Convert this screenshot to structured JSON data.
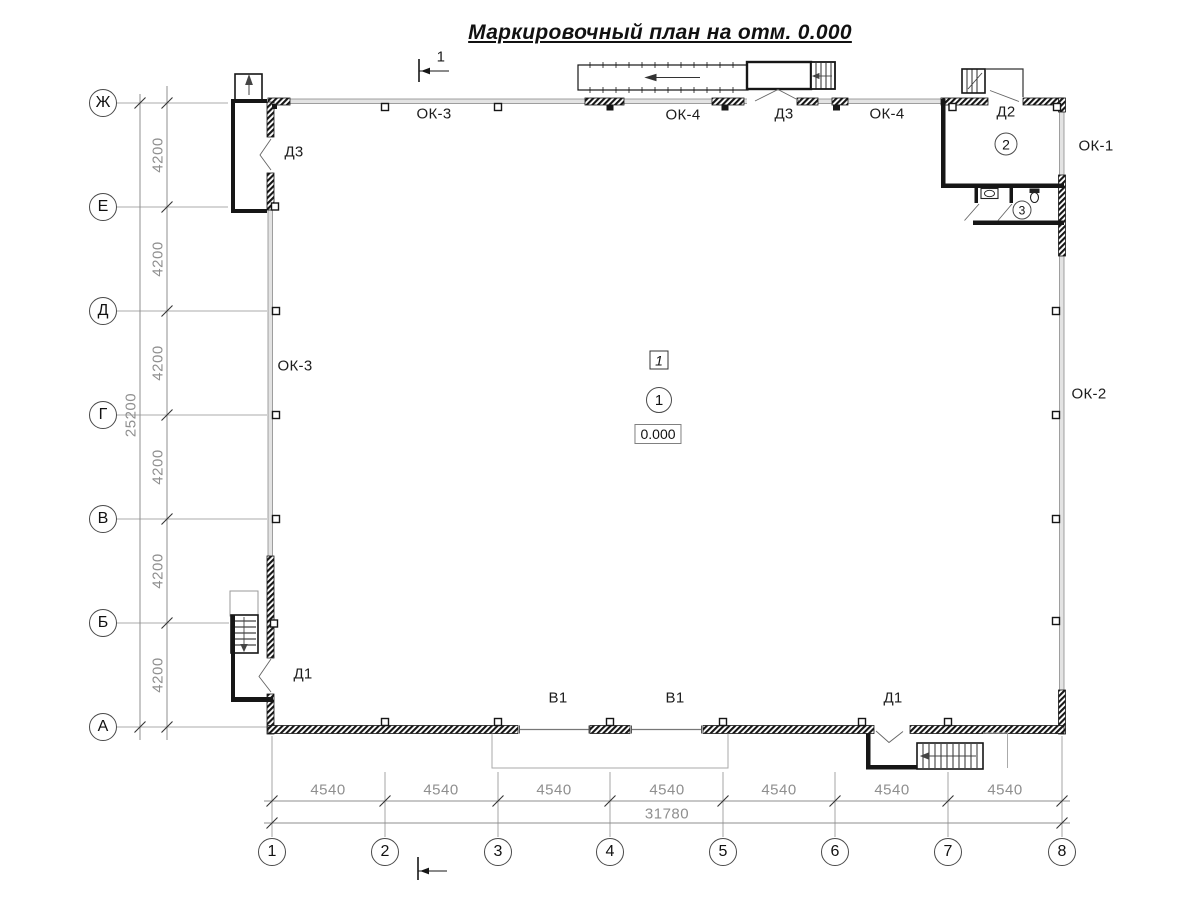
{
  "title": "Маркировочный план на отм. 0.000",
  "axes": {
    "rows": [
      "Ж",
      "Е",
      "Д",
      "Г",
      "В",
      "Б",
      "А"
    ],
    "cols": [
      "1",
      "2",
      "3",
      "4",
      "5",
      "6",
      "7",
      "8"
    ],
    "row_spacing": "4200",
    "row_total": "25200",
    "col_spacing": "4540",
    "col_total": "31780"
  },
  "section_mark": {
    "number": "1"
  },
  "markers": {
    "room1_circle": "1",
    "room2_circle": "2",
    "room3_circle": "3",
    "unit_square": "1",
    "elevation": "0.000"
  },
  "openings": {
    "ok1": "ОК-1",
    "ok2": "ОК-2",
    "ok3": "ОК-3",
    "ok4": "ОК-4",
    "d1": "Д1",
    "d2": "Д2",
    "d3": "Д3",
    "v1": "В1"
  }
}
